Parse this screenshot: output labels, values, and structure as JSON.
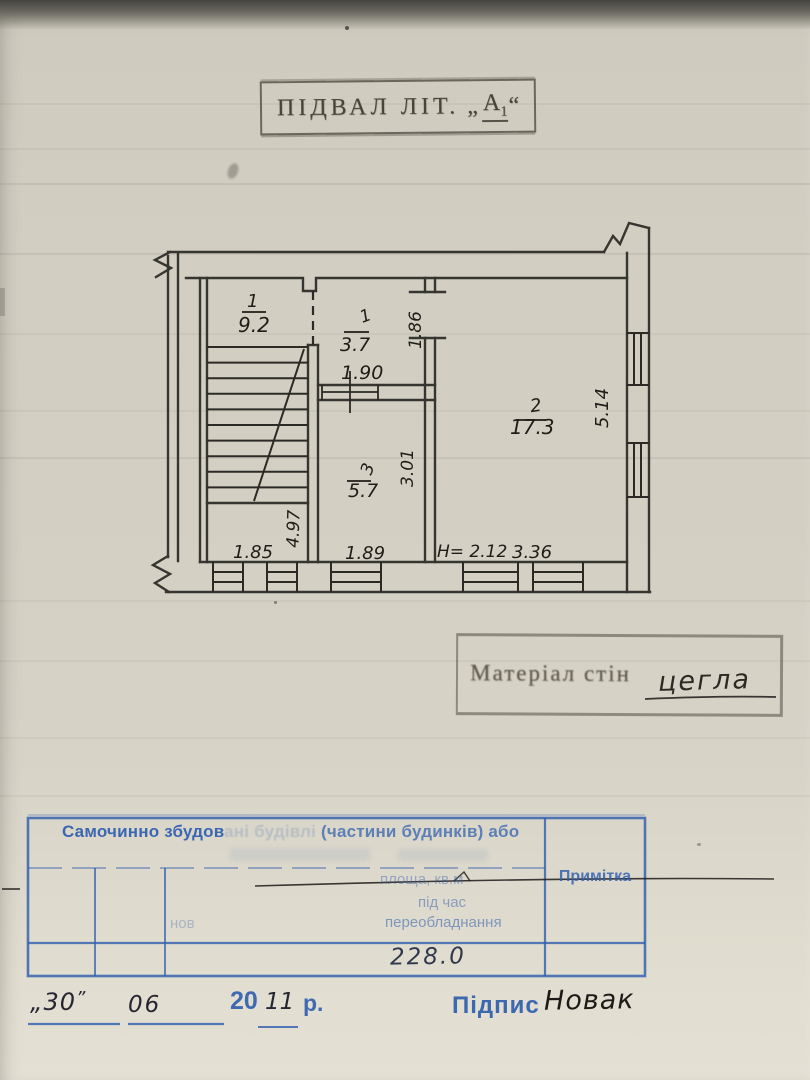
{
  "stamps": {
    "title": {
      "text": "ПІДВАЛ ЛІТ.",
      "quote_open": "„",
      "letter": "А",
      "letter_index": "1",
      "quote_close": "“"
    },
    "material": {
      "label": "Матеріал стін",
      "value": "цегла"
    }
  },
  "plan": {
    "rooms": [
      {
        "number": "1",
        "area": "9.2"
      },
      {
        "number": "1",
        "area": "3.7"
      },
      {
        "number": "2",
        "area": "17.3"
      },
      {
        "number": "3",
        "area": "5.7"
      }
    ],
    "dims": {
      "opening": "1.86",
      "door_width": "1.90",
      "room3_depth": "3.01",
      "stair_depth": "4.97",
      "room2_depth": "5.14",
      "left_width": "1.85",
      "room3_width": "1.89",
      "ceiling_height": "H= 2.12",
      "room2_width": "3.36"
    }
  },
  "table": {
    "header": {
      "part_strong": "Самочинно збудов",
      "part_faded": "ані будівлі ",
      "part_tail": "(частини будинків) або"
    },
    "mid": {
      "line1": "площа, кв.м",
      "line2": "під час",
      "line3_left": "нов",
      "line3_right": "переобладнання"
    },
    "note_col": "Примітка",
    "total": "228.0"
  },
  "footer": {
    "quote_open": "„",
    "day": "30",
    "quote_close": "”",
    "month": "06",
    "year_prefix": "20",
    "year": "11",
    "year_suffix": "р.",
    "signature_label": "Підпис",
    "signature_name": "Новак"
  },
  "colors": {
    "ink": "#2b2a25",
    "stamp_blue": "#2e5eae",
    "paper": "#d2cec2",
    "pen_black": "#1c1a17"
  }
}
